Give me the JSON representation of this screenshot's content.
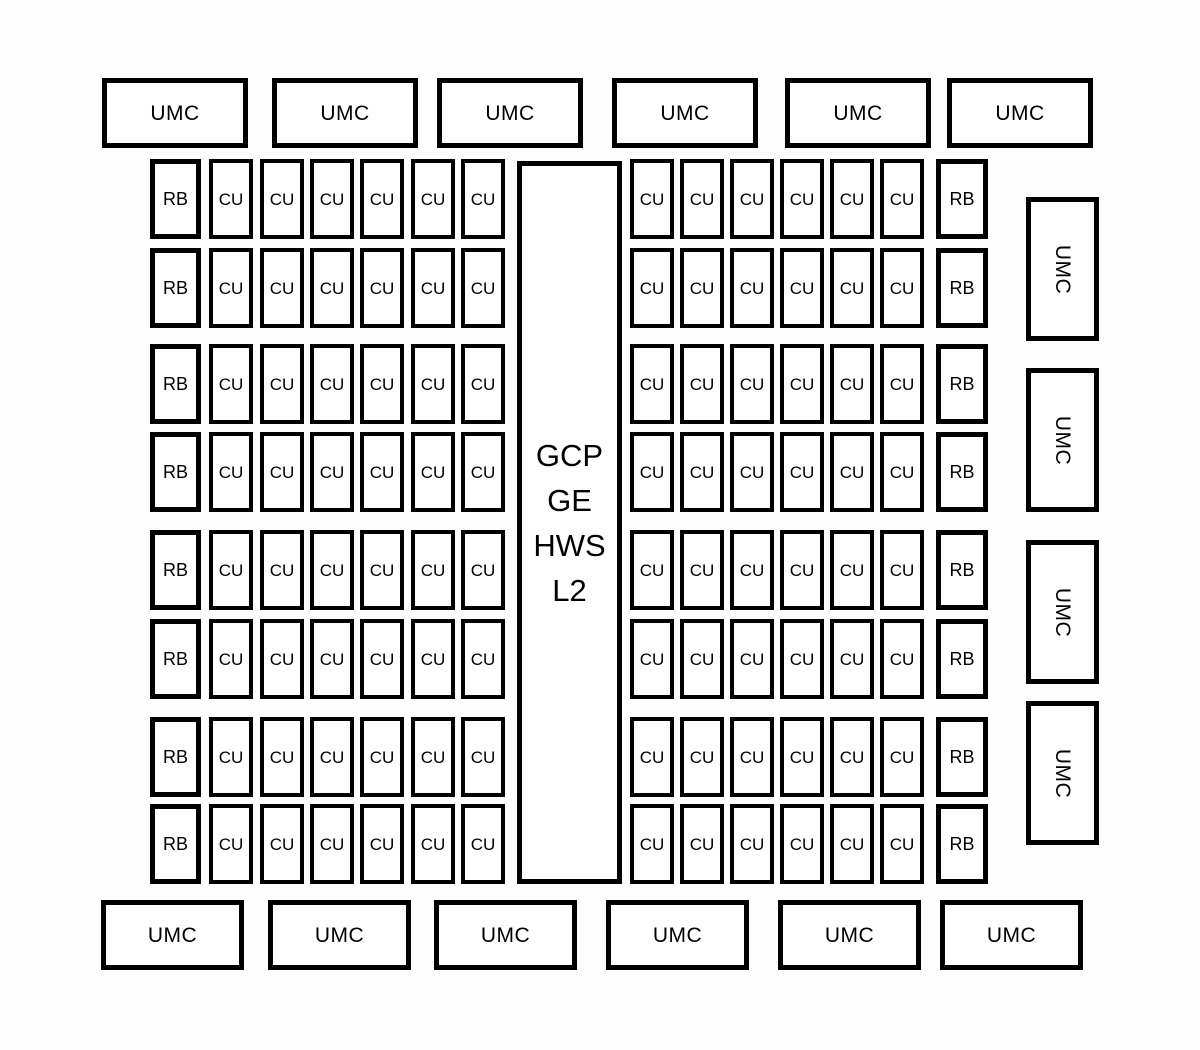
{
  "figure": {
    "type": "chip-floorplan-block-diagram",
    "center_block": {
      "lines": [
        "GCP",
        "GE",
        "HWS",
        "L2"
      ]
    },
    "block_labels": {
      "umc": "UMC",
      "cu": "CU",
      "rb": "RB"
    },
    "top_umc": {
      "count": 6,
      "labels": [
        "UMC",
        "UMC",
        "UMC",
        "UMC",
        "UMC",
        "UMC"
      ]
    },
    "bottom_umc": {
      "count": 6,
      "labels": [
        "UMC",
        "UMC",
        "UMC",
        "UMC",
        "UMC",
        "UMC"
      ]
    },
    "right_umc": {
      "count": 4,
      "labels": [
        "UMC",
        "UMC",
        "UMC",
        "UMC"
      ]
    },
    "shader_rows": {
      "count": 8,
      "left_row_pattern": [
        "RB",
        "CU",
        "CU",
        "CU",
        "CU",
        "CU",
        "CU"
      ],
      "right_row_pattern": [
        "CU",
        "CU",
        "CU",
        "CU",
        "CU",
        "CU",
        "RB"
      ]
    },
    "colors": {
      "border": "#000000",
      "block_fill": "#fefefe",
      "page_background": "#fdfdfd",
      "text": "#000000"
    }
  }
}
